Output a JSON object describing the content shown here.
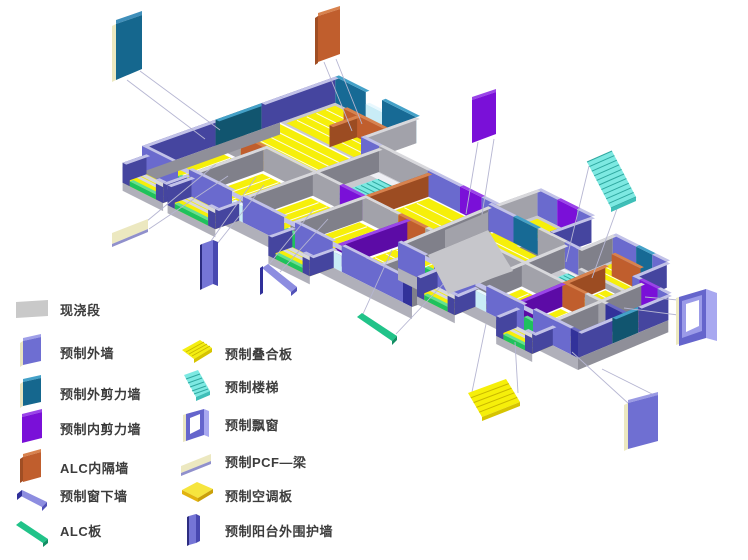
{
  "legend": {
    "left": [
      {
        "label": "现浇段",
        "icon": "cast-in-place-segment-icon",
        "color": "#c9c9c9"
      },
      {
        "label": "预制外墙",
        "icon": "precast-exterior-wall-icon",
        "color": "#6e6ed2"
      },
      {
        "label": "预制外剪力墙",
        "icon": "precast-exterior-shear-wall-icon",
        "color": "#15678e"
      },
      {
        "label": "预制内剪力墙",
        "icon": "precast-interior-shear-wall-icon",
        "color": "#7a10d8"
      },
      {
        "label": "ALC内隔墙",
        "icon": "alc-interior-partition-wall-icon",
        "color": "#c05e2d"
      },
      {
        "label": "预制窗下墙",
        "icon": "precast-window-sill-wall-icon",
        "color": "#8d8de0"
      },
      {
        "label": "ALC板",
        "icon": "alc-panel-icon",
        "color": "#21c389"
      }
    ],
    "right": [
      {
        "label": "预制叠合板",
        "icon": "precast-composite-slab-icon",
        "color": "#f4ee12"
      },
      {
        "label": "预制楼梯",
        "icon": "precast-stair-icon",
        "color": "#7de9e2"
      },
      {
        "label": "预制飘窗",
        "icon": "precast-bay-window-icon",
        "color": "#6565cc"
      },
      {
        "label": "预制PCF—梁",
        "icon": "precast-pcf-beam-icon",
        "color": "#ece8c0"
      },
      {
        "label": "预制空调板",
        "icon": "precast-ac-slab-icon",
        "color": "#f6e53e"
      },
      {
        "label": "预制阳台外围护墙",
        "icon": "precast-balcony-enclosure-wall-icon",
        "color": "#7575d6"
      }
    ]
  },
  "scene": {
    "callouts": [
      {
        "name": "precast-exterior-shear-wall",
        "color": "#15678e"
      },
      {
        "name": "alc-interior-partition-wall",
        "color": "#c05e2d"
      },
      {
        "name": "precast-interior-shear-wall",
        "color": "#7a10d8"
      },
      {
        "name": "precast-stair",
        "color": "#7de9e2"
      },
      {
        "name": "precast-bay-window",
        "color": "#6565cc"
      },
      {
        "name": "precast-exterior-wall",
        "color": "#6f6fd2"
      },
      {
        "name": "precast-composite-slab",
        "color": "#f6ef0a"
      },
      {
        "name": "alc-panel",
        "color": "#21c389"
      },
      {
        "name": "precast-pcf-beam",
        "color": "#ece8c0"
      },
      {
        "name": "precast-balcony-enclosure-wall",
        "color": "#7575d6"
      },
      {
        "name": "precast-window-sill-wall",
        "color": "#8d8de0"
      }
    ],
    "colors": {
      "periw": "#6a6ace",
      "periwDark": "#45459f",
      "periwTop": "#c2c2e8",
      "gray": "#a2a2aa",
      "grayDark": "#80808a",
      "grayTop": "#d8d8dc",
      "slab": "#c9c9cf",
      "slabEdge": "#b0b0ba",
      "slabEdge2": "#8f8f99",
      "floorYellow": "#f6ef0a",
      "stripe": "#fdfdec",
      "teal": "#176a95",
      "tealDark": "#11556f",
      "tealTop": "#44a1c8",
      "purple": "#7a10d8",
      "purpleDark": "#5c0ba6",
      "purpleTop": "#9a44e8",
      "orange": "#c05e2d",
      "orangeDark": "#9c4c22",
      "orangeTop": "#d8824e",
      "green": "#1fc15e",
      "greenTop": "#63e094",
      "navy": "#32329a",
      "navyTop": "#6a6ac4",
      "cyan": "#7de9e2",
      "cyanDark": "#3fbfb8",
      "cyanLine": "#2fa8a0",
      "glaz": "#c9ecf6",
      "glazTop": "#e8f8fe",
      "cream": "#ece8c0",
      "landing": "#efeff4",
      "leader": "#b6b6d2"
    }
  }
}
